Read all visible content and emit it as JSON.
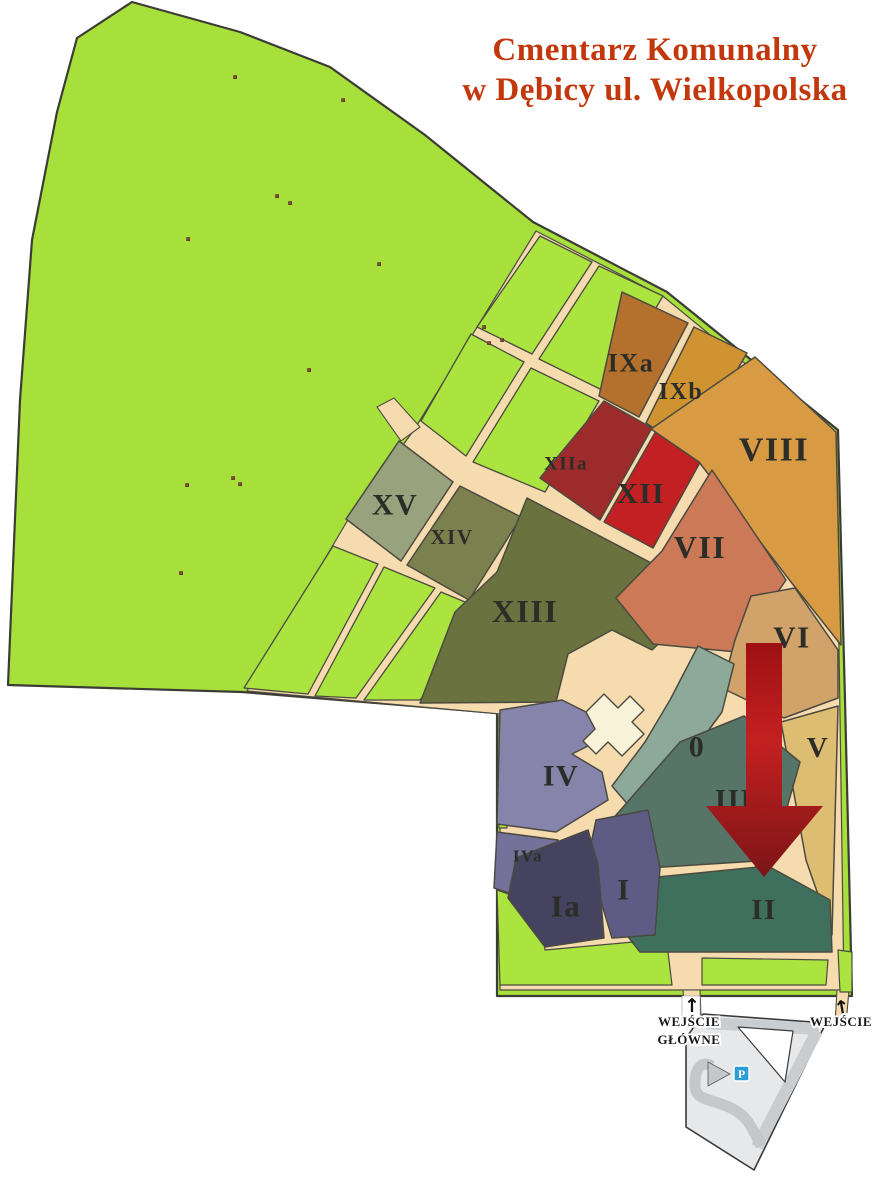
{
  "title": {
    "line1": "Cmentarz Komunalny",
    "line2": "w Dębicy ul. Wielkopolska",
    "color": "#c2380c"
  },
  "map": {
    "ground_color": "#a7df3b",
    "cell_color": "#abe43f",
    "road_color": "#f6dbae",
    "outline_color": "#3c3c34",
    "section_stroke": "#4b4a40",
    "label_color": "#2d2d28",
    "dot_color": "#8a4a38",
    "building_color": "#f8f2d8",
    "outline": "132,2 240,32 330,67 425,135 533,222 667,292 838,430 845,700 852,996 497,996 497,713 242,692 8,685 20,400 32,240 57,112 77,38",
    "developed_area": "536,231 664,297 831,434 839,648 844,990 500,990 500,714 247,691 349,518 414,430",
    "road_stubs": [
      "377,407 394,398 420,427 401,441",
      "683,990 700,990 701,1016 685,1016",
      "837,990 849,990 846,1024 835,1024"
    ],
    "green_cells": [
      "540,236 592,262 532,354 477,327",
      "599,266 663,296 606,392 539,359",
      "471,334 524,362 466,456 421,421",
      "531,368 599,401 545,492 473,462",
      "333,546 378,564 308,694 244,688",
      "384,567 435,588 356,698 315,696",
      "441,592 489,612 420,700 364,700"
    ],
    "green_patches": [
      "497,890 540,905 545,950 655,940 668,952 672,985 500,985",
      "702,958 828,960 826,985 702,985",
      "838,950 852,952 852,992 840,992",
      "499,716 507,716 507,828 499,828"
    ],
    "green_strips": [
      "627,808 640,805 633,876 620,874",
      "645,804 658,801 652,872 639,875",
      "659,886 672,883 668,950 655,948",
      "677,882 690,879 686,946 673,948"
    ],
    "dots": [
      [
        235,
        77
      ],
      [
        343,
        100
      ],
      [
        277,
        196
      ],
      [
        290,
        203
      ],
      [
        188,
        239
      ],
      [
        379,
        264
      ],
      [
        309,
        370
      ],
      [
        233,
        478
      ],
      [
        240,
        484
      ],
      [
        187,
        485
      ],
      [
        181,
        573
      ],
      [
        484,
        327
      ],
      [
        502,
        340
      ],
      [
        489,
        343
      ]
    ],
    "building": "586,712 604,694 618,708 630,696 644,710 632,722 644,734 622,756 608,742 596,754 583,741 595,729",
    "sections": [
      {
        "id": "XV",
        "label": "XV",
        "color": "#98a27d",
        "points": "399,441 453,482 401,561 346,519",
        "lx": 395,
        "ly": 505,
        "fs": 30
      },
      {
        "id": "XIV",
        "label": "XIV",
        "color": "#7a814f",
        "points": "460,486 521,517 469,600 407,565",
        "lx": 452,
        "ly": 537,
        "fs": 21
      },
      {
        "id": "XIII",
        "label": "XIII",
        "color": "#6a7240",
        "points": "527,498 657,566 686,618 652,650 612,630 568,654 556,702 420,703 455,612 497,572",
        "lx": 525,
        "ly": 611,
        "fs": 32
      },
      {
        "id": "XIIa",
        "label": "XIIa",
        "color": "#9e2b2b",
        "points": "604,401 652,428 600,520 540,478",
        "lx": 566,
        "ly": 464,
        "fs": 19
      },
      {
        "id": "XII",
        "label": "XII",
        "color": "#c32024",
        "points": "656,431 703,457 653,548 604,522",
        "lx": 641,
        "ly": 494,
        "fs": 29
      },
      {
        "id": "IXa",
        "label": "IXa",
        "color": "#b4712e",
        "points": "622,292 688,323 639,417 599,396",
        "lx": 631,
        "ly": 363,
        "fs": 26
      },
      {
        "id": "IXb",
        "label": "IXb",
        "color": "#cf9332",
        "points": "694,327 747,353 689,452 646,423",
        "lx": 681,
        "ly": 392,
        "fs": 24
      },
      {
        "id": "VIII",
        "label": "VIII",
        "color": "#d89b43",
        "points": "755,357 836,432 841,645 791,582 699,462 651,429",
        "lx": 774,
        "ly": 450,
        "fs": 34
      },
      {
        "id": "VII",
        "label": "VII",
        "color": "#cb7957",
        "points": "712,470 786,580 737,652 653,644 616,598 662,551",
        "lx": 700,
        "ly": 547,
        "fs": 32
      },
      {
        "id": "VI",
        "label": "VI",
        "color": "#d1a26a",
        "points": "751,596 795,588 838,650 838,698 784,718 722,688 735,640",
        "lx": 792,
        "ly": 637,
        "fs": 31
      },
      {
        "id": "V",
        "label": "V",
        "color": "#dcbd71",
        "points": "781,722 838,706 832,935 806,860",
        "lx": 818,
        "ly": 748,
        "fs": 29
      },
      {
        "id": "0",
        "label": "0",
        "color": "#8da99a",
        "points": "698,646 734,664 722,712 700,742 668,802 636,814 612,786 645,742 670,700",
        "lx": 697,
        "ly": 747,
        "fs": 30
      },
      {
        "id": "III",
        "label": "III",
        "color": "#567568",
        "points": "744,716 800,762 772,860 648,868 610,822 680,742",
        "lx": 734,
        "ly": 800,
        "fs": 29
      },
      {
        "id": "II",
        "label": "II",
        "color": "#3f705e",
        "points": "628,880 768,866 830,900 832,952 640,952 615,920",
        "lx": 764,
        "ly": 910,
        "fs": 29
      },
      {
        "id": "IV",
        "label": "IV",
        "color": "#8684ab",
        "points": "500,710 562,700 594,716 600,740 572,754 602,772 608,800 556,832 497,824",
        "lx": 561,
        "ly": 776,
        "fs": 30
      },
      {
        "id": "IVa",
        "label": "IVa",
        "color": "#74719a",
        "points": "497,832 558,840 536,902 494,888",
        "lx": 528,
        "ly": 856,
        "fs": 17
      },
      {
        "id": "I",
        "label": "I",
        "color": "#5e5c84",
        "points": "596,820 648,810 660,868 655,935 612,938 588,858",
        "lx": 624,
        "ly": 890,
        "fs": 30
      },
      {
        "id": "Ia",
        "label": "Ia",
        "color": "#45435f",
        "points": "516,858 588,830 598,864 604,938 545,947 508,898",
        "lx": 566,
        "ly": 906,
        "fs": 31
      }
    ]
  },
  "arrow": {
    "gradient": [
      "#9d1113",
      "#c42020",
      "#7c1517"
    ],
    "shaft": {
      "x": 746,
      "y": 643,
      "w": 36,
      "h": 166
    },
    "head": "706,806 823,806 764,877"
  },
  "bottom": {
    "parking": {
      "fill": "#e6e8ea",
      "band": "#c9cdd0",
      "stroke": "#3a3a3a",
      "outer": "703,1014 826,1023 754,1170 686,1127 686,1038",
      "hole": "738,1027 793,1031 785,1082",
      "p_color": "#2b9ed8",
      "p_label": "P"
    },
    "main_entrance": {
      "line1": "WEJŚCIE",
      "line2": "GŁÓWNE",
      "x": 689,
      "y1": 1026,
      "y2": 1044,
      "arrow_x": 692,
      "arrow_y": 1012
    },
    "side_entrance": {
      "label": "WEJŚCIE",
      "x": 841,
      "y": 1026,
      "arrow_x": 843,
      "arrow_y": 1014
    },
    "arrow_glyph": "↑"
  }
}
